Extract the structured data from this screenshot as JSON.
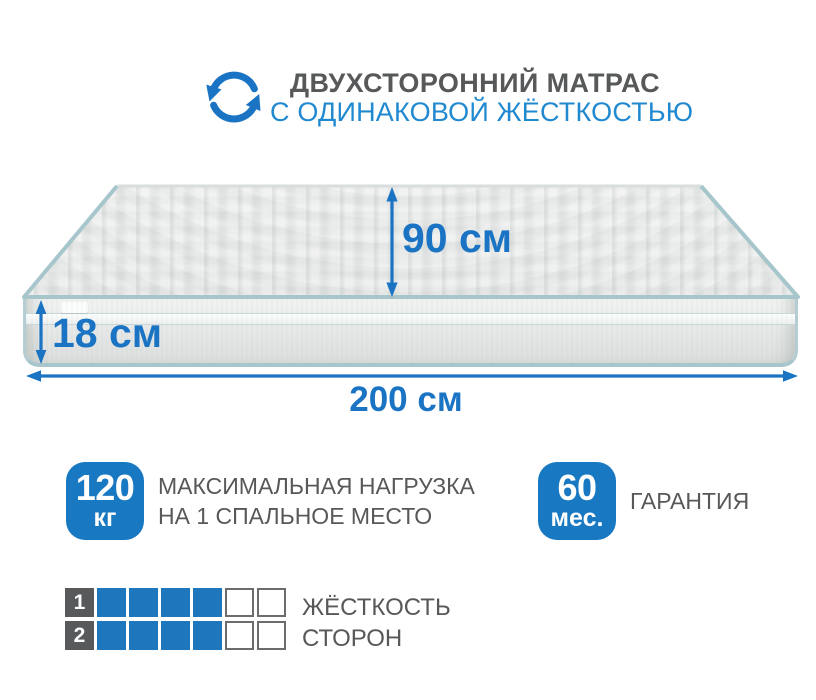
{
  "header": {
    "icon": "rotate-arrows-icon",
    "title": "ДВУХСТОРОННИЙ МАТРАС",
    "subtitle": "С ОДИНАКОВОЙ ЖЁСТКОСТЬЮ"
  },
  "dimensions": {
    "depth": "90 см",
    "height": "18 см",
    "width": "200 см"
  },
  "features": {
    "max_load": {
      "value": "120",
      "unit": "кг",
      "label_line1": "МАКСИМАЛЬНАЯ НАГРУЗКА",
      "label_line2": "НА 1 СПАЛЬНОЕ МЕСТО"
    },
    "warranty": {
      "value": "60",
      "unit": "мес.",
      "label": "ГАРАНТИЯ"
    }
  },
  "firmness": {
    "rows": [
      {
        "label": "1",
        "filled": 4,
        "empty": 2
      },
      {
        "label": "2",
        "filled": 4,
        "empty": 2
      }
    ],
    "caption_line1": "ЖЁСТКОСТЬ",
    "caption_line2": "СТОРОН"
  },
  "colors": {
    "accent_blue": "#1b74c3",
    "header_blue": "#2089cf",
    "badge_blue": "#1878c1",
    "scale_blue": "#1e76bd",
    "scale_label_bg": "#58595b",
    "empty_cell_border": "#6b6c6e",
    "text_gray": "#57585a",
    "piping": "#a7c6cc"
  }
}
